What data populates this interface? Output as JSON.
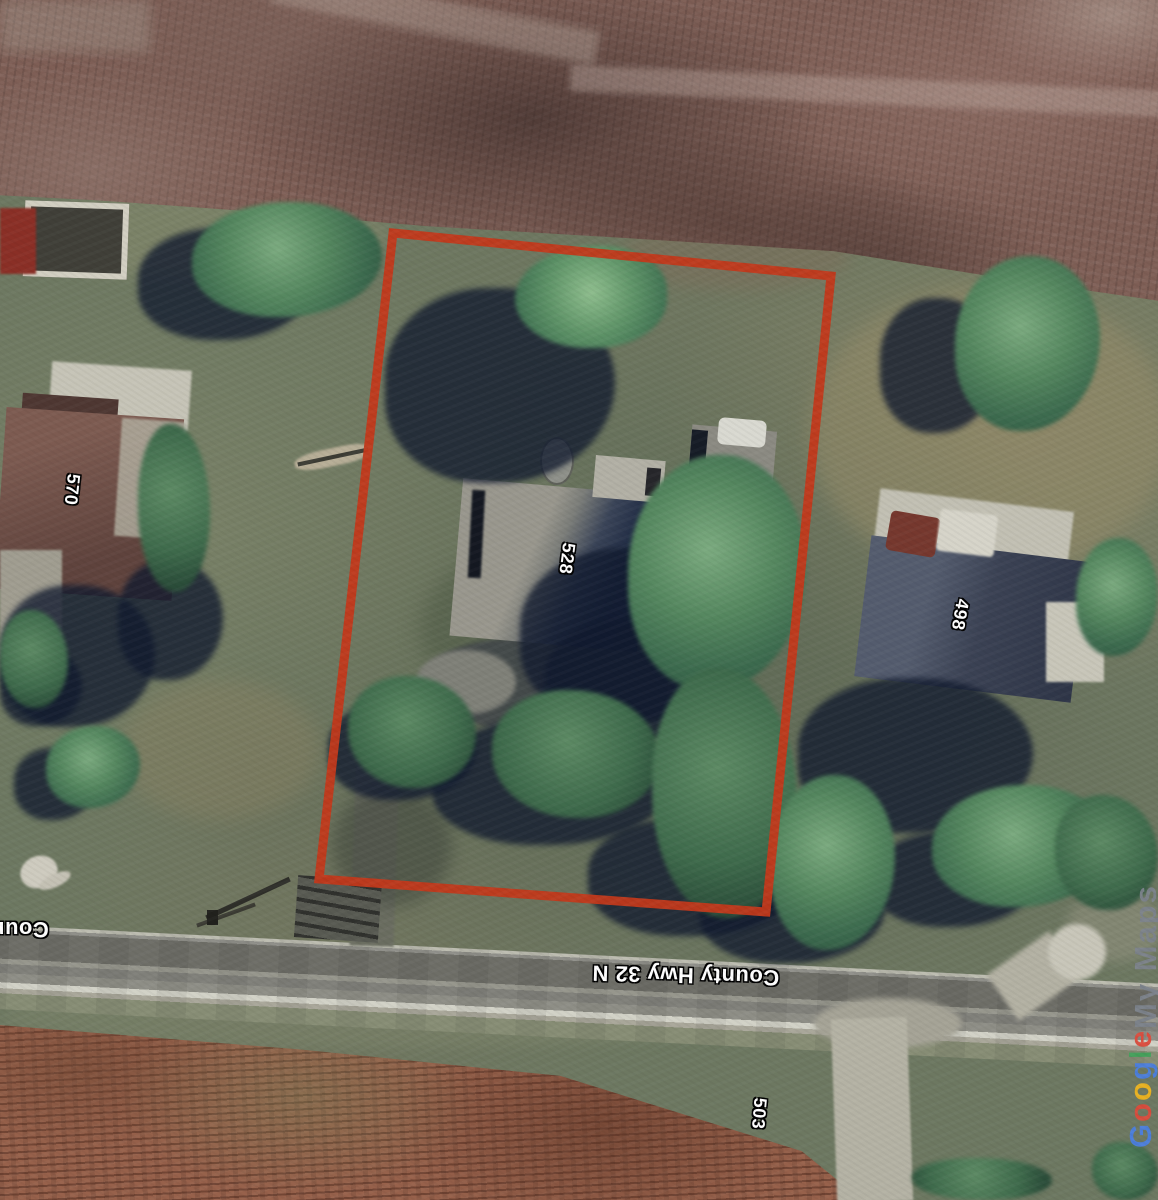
{
  "labels": {
    "house_570": "570",
    "house_528": "528",
    "house_498": "498",
    "house_503": "503"
  },
  "road": {
    "label": "County Hwy 32 N",
    "label_partial": "County"
  },
  "watermark": {
    "letters": [
      {
        "ch": "G",
        "color": "#4b7fe0"
      },
      {
        "ch": "o",
        "color": "#dd4b3c"
      },
      {
        "ch": "o",
        "color": "#efb51f"
      },
      {
        "ch": "g",
        "color": "#4b7fe0"
      },
      {
        "ch": "l",
        "color": "#42a25a"
      },
      {
        "ch": "e",
        "color": "#dd4b3c"
      }
    ],
    "suffix": "My Maps",
    "suffix_color": "#7d838c"
  },
  "boundary": {
    "color": "#c2391b"
  }
}
